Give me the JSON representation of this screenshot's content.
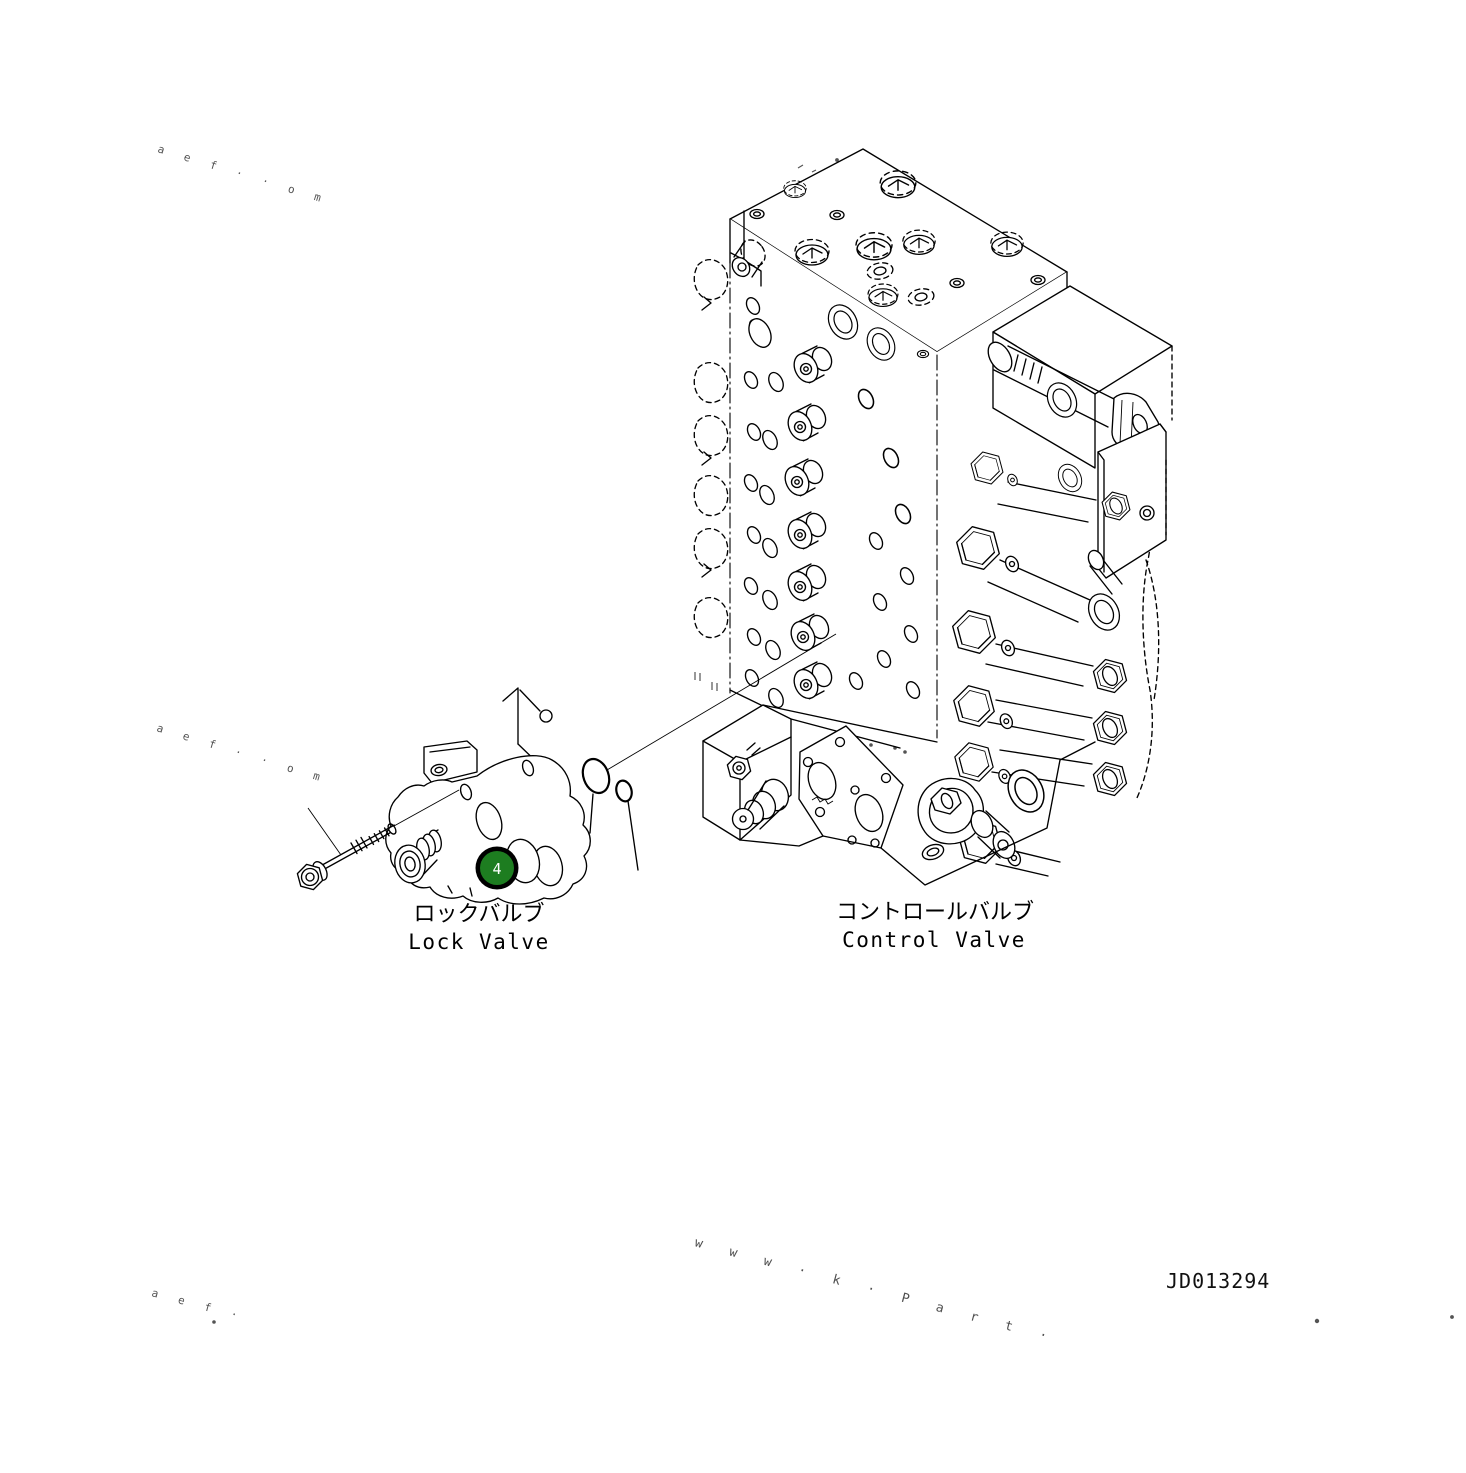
{
  "page": {
    "width": 1466,
    "height": 1473,
    "background_color": "#ffffff",
    "line_color": "#000000"
  },
  "drawing": {
    "drawing_number": "JD013294",
    "callout": {
      "number": "4",
      "fill_color": "#1d7d20",
      "ring_color": "#000000",
      "number_color": "#ffffff"
    },
    "parts": {
      "lock_valve": {
        "label_jp": "ロックバルブ",
        "label_en": "Lock Valve"
      },
      "control_valve": {
        "label_jp": "コントロールバルブ",
        "label_en": "Control Valve"
      }
    },
    "watermarks": {
      "diagonal_fragments": "a e f  ·  ·  o m",
      "diagonal_fragments_short": "a e f ·",
      "bottom_fragments": "w w w · k · P a r t ·"
    }
  }
}
